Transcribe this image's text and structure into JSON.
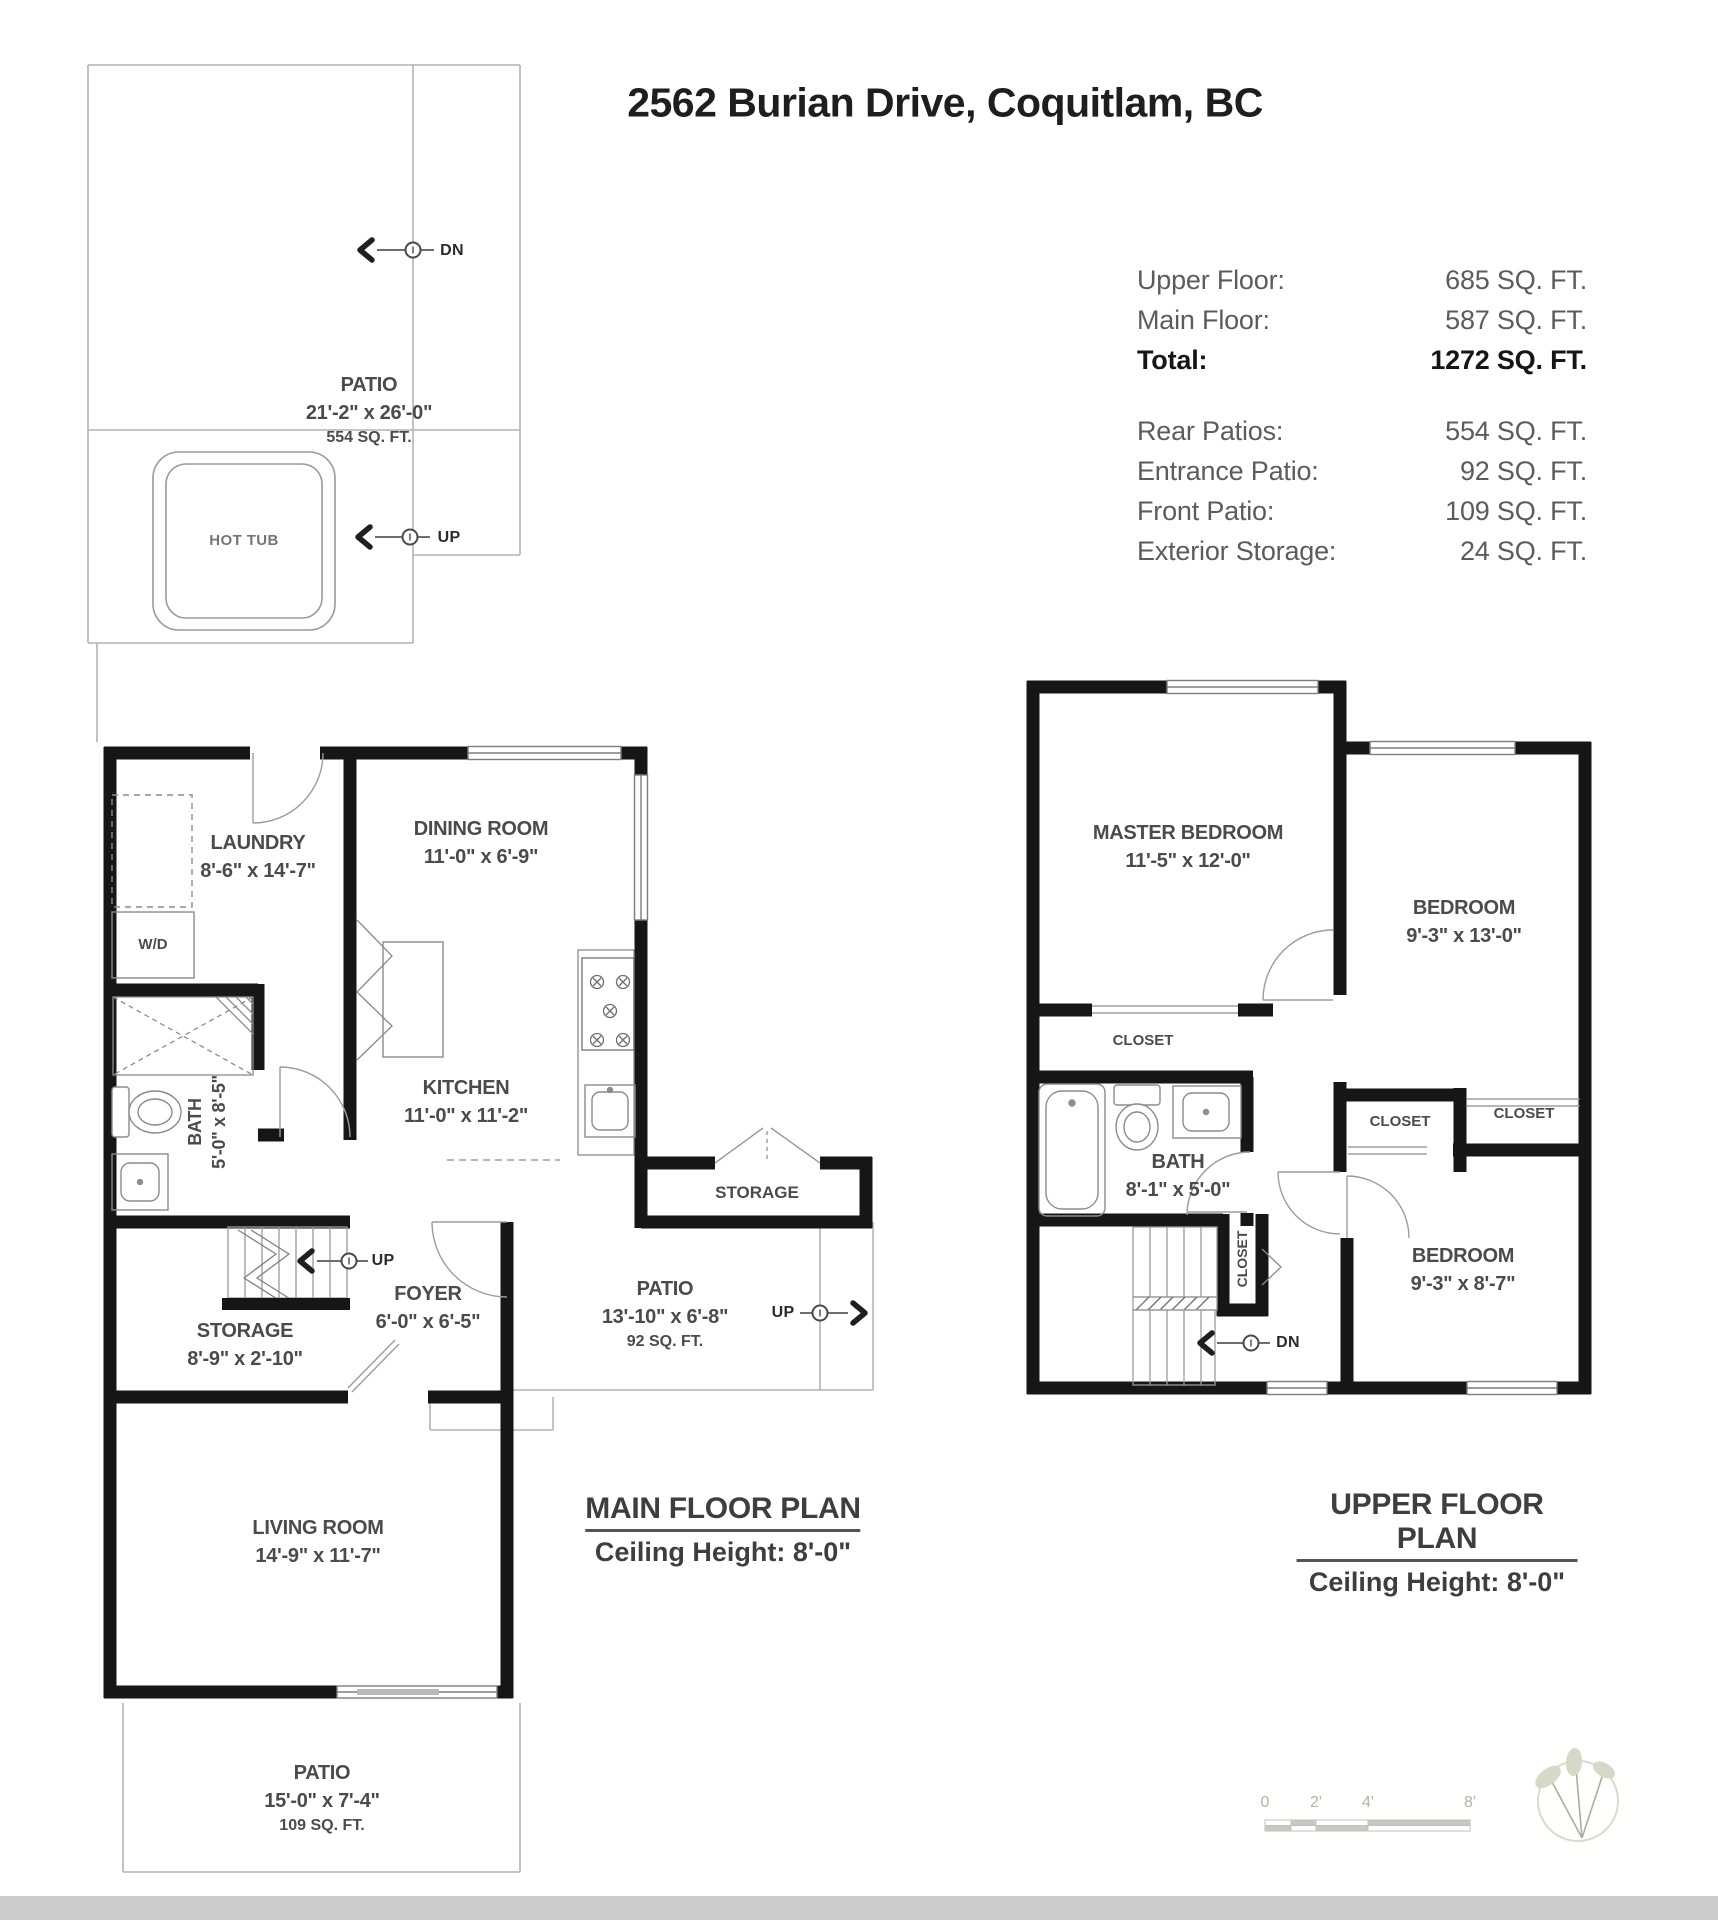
{
  "title": "2562 Burian Drive, Coquitlam, BC",
  "area_table": {
    "main_rows": [
      {
        "label": "Upper Floor:",
        "value": "685 SQ. FT."
      },
      {
        "label": "Main Floor:",
        "value": "587 SQ. FT."
      }
    ],
    "total_row": {
      "label": "Total:",
      "value": "1272 SQ. FT."
    },
    "secondary_rows": [
      {
        "label": "Rear Patios:",
        "value": "554 SQ. FT."
      },
      {
        "label": "Entrance Patio:",
        "value": "92 SQ. FT."
      },
      {
        "label": "Front Patio:",
        "value": "109 SQ. FT."
      },
      {
        "label": "Exterior Storage:",
        "value": "24 SQ. FT."
      }
    ]
  },
  "main_floor": {
    "plan_title": "MAIN FLOOR PLAN",
    "ceiling": "Ceiling Height: 8'-0\"",
    "rear_patio": {
      "name": "PATIO",
      "dims": "21'-2\" x 26'-0\"",
      "area": "554 SQ. FT."
    },
    "hot_tub": "HOT TUB",
    "laundry": {
      "name": "LAUNDRY",
      "dims": "8'-6\" x 14'-7\""
    },
    "wd": "W/D",
    "dining": {
      "name": "DINING ROOM",
      "dims": "11'-0\" x 6'-9\""
    },
    "kitchen": {
      "name": "KITCHEN",
      "dims": "11'-0\" x 11'-2\""
    },
    "bath": {
      "name": "BATH",
      "dims": "5'-0\" x 8'-5\""
    },
    "storage": {
      "name": "STORAGE",
      "dims": "8'-9\" x 2'-10\""
    },
    "foyer": {
      "name": "FOYER",
      "dims": "6'-0\" x 6'-5\""
    },
    "ext_storage": "STORAGE",
    "entrance_patio": {
      "name": "PATIO",
      "dims": "13'-10\" x 6'-8\"",
      "area": "92 SQ. FT."
    },
    "living": {
      "name": "LIVING ROOM",
      "dims": "14'-9\" x 11'-7\""
    },
    "front_patio": {
      "name": "PATIO",
      "dims": "15'-0\" x 7'-4\"",
      "area": "109 SQ. FT."
    },
    "arrow_dn": "DN",
    "arrow_up_patio": "UP",
    "arrow_up_stairs": "UP",
    "arrow_up_entrance": "UP"
  },
  "upper_floor": {
    "plan_title": "UPPER FLOOR PLAN",
    "ceiling": "Ceiling Height: 8'-0\"",
    "master": {
      "name": "MASTER BEDROOM",
      "dims": "11'-5\" x 12'-0\""
    },
    "bedroom1": {
      "name": "BEDROOM",
      "dims": "9'-3\" x 13'-0\""
    },
    "bedroom2": {
      "name": "BEDROOM",
      "dims": "9'-3\" x 8'-7\""
    },
    "bath": {
      "name": "BATH",
      "dims": "8'-1\" x 5'-0\""
    },
    "closet_master": "CLOSET",
    "closet_a": "CLOSET",
    "closet_b": "CLOSET",
    "closet_stairs": "CLOSET",
    "arrow_dn": "DN"
  },
  "scale_bar": {
    "ticks": [
      "0",
      "2'",
      "4'",
      "8'"
    ]
  }
}
